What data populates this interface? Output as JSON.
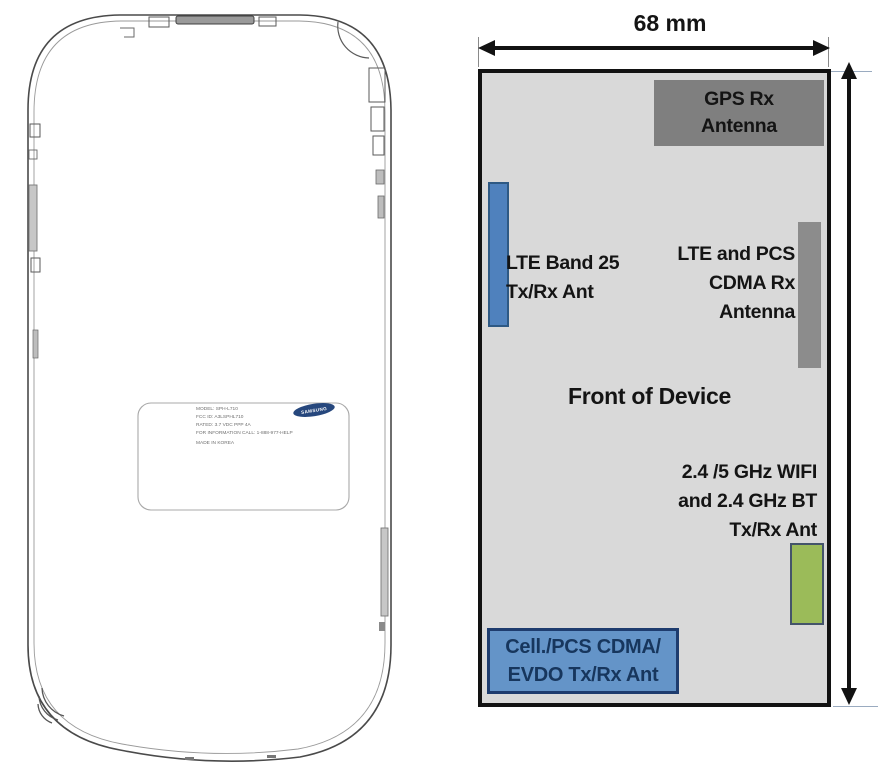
{
  "dimension": {
    "width_label": "68 mm"
  },
  "device_panel": {
    "panel_color": "#d9d9d9",
    "front_label": "Front of Device",
    "antennas": {
      "gps": {
        "lines": [
          "GPS Rx",
          "Antenna"
        ],
        "block_color": "#7f7f7f"
      },
      "lte_band25": {
        "lines": [
          "LTE Band 25",
          "Tx/Rx Ant"
        ],
        "bar_color": "#4f81bd"
      },
      "lte_pcs_cdma_rx": {
        "lines": [
          "LTE and PCS",
          "CDMA Rx",
          "Antenna"
        ],
        "bar_color": "#8c8c8c"
      },
      "wifi_bt": {
        "lines": [
          "2.4 /5 GHz WIFI",
          "and 2.4 GHz BT",
          "Tx/Rx Ant"
        ],
        "block_color": "#9bbb59"
      },
      "cell_pcs_evdo": {
        "lines": [
          "Cell./PCS CDMA/",
          "EVDO Tx/Rx Ant"
        ],
        "block_color": "#6494c8",
        "text_color": "#17365d"
      }
    }
  },
  "phone_label": {
    "brand": "SAMSUNG",
    "lines": [
      "MODEL: SPH-L710",
      "FCC ID: A3LSPHL710",
      "RATED: 3.7 VDC  PPP 4A",
      "FOR INFORMATION CALL: 1-888-977-HELP",
      "MADE IN KOREA"
    ]
  }
}
